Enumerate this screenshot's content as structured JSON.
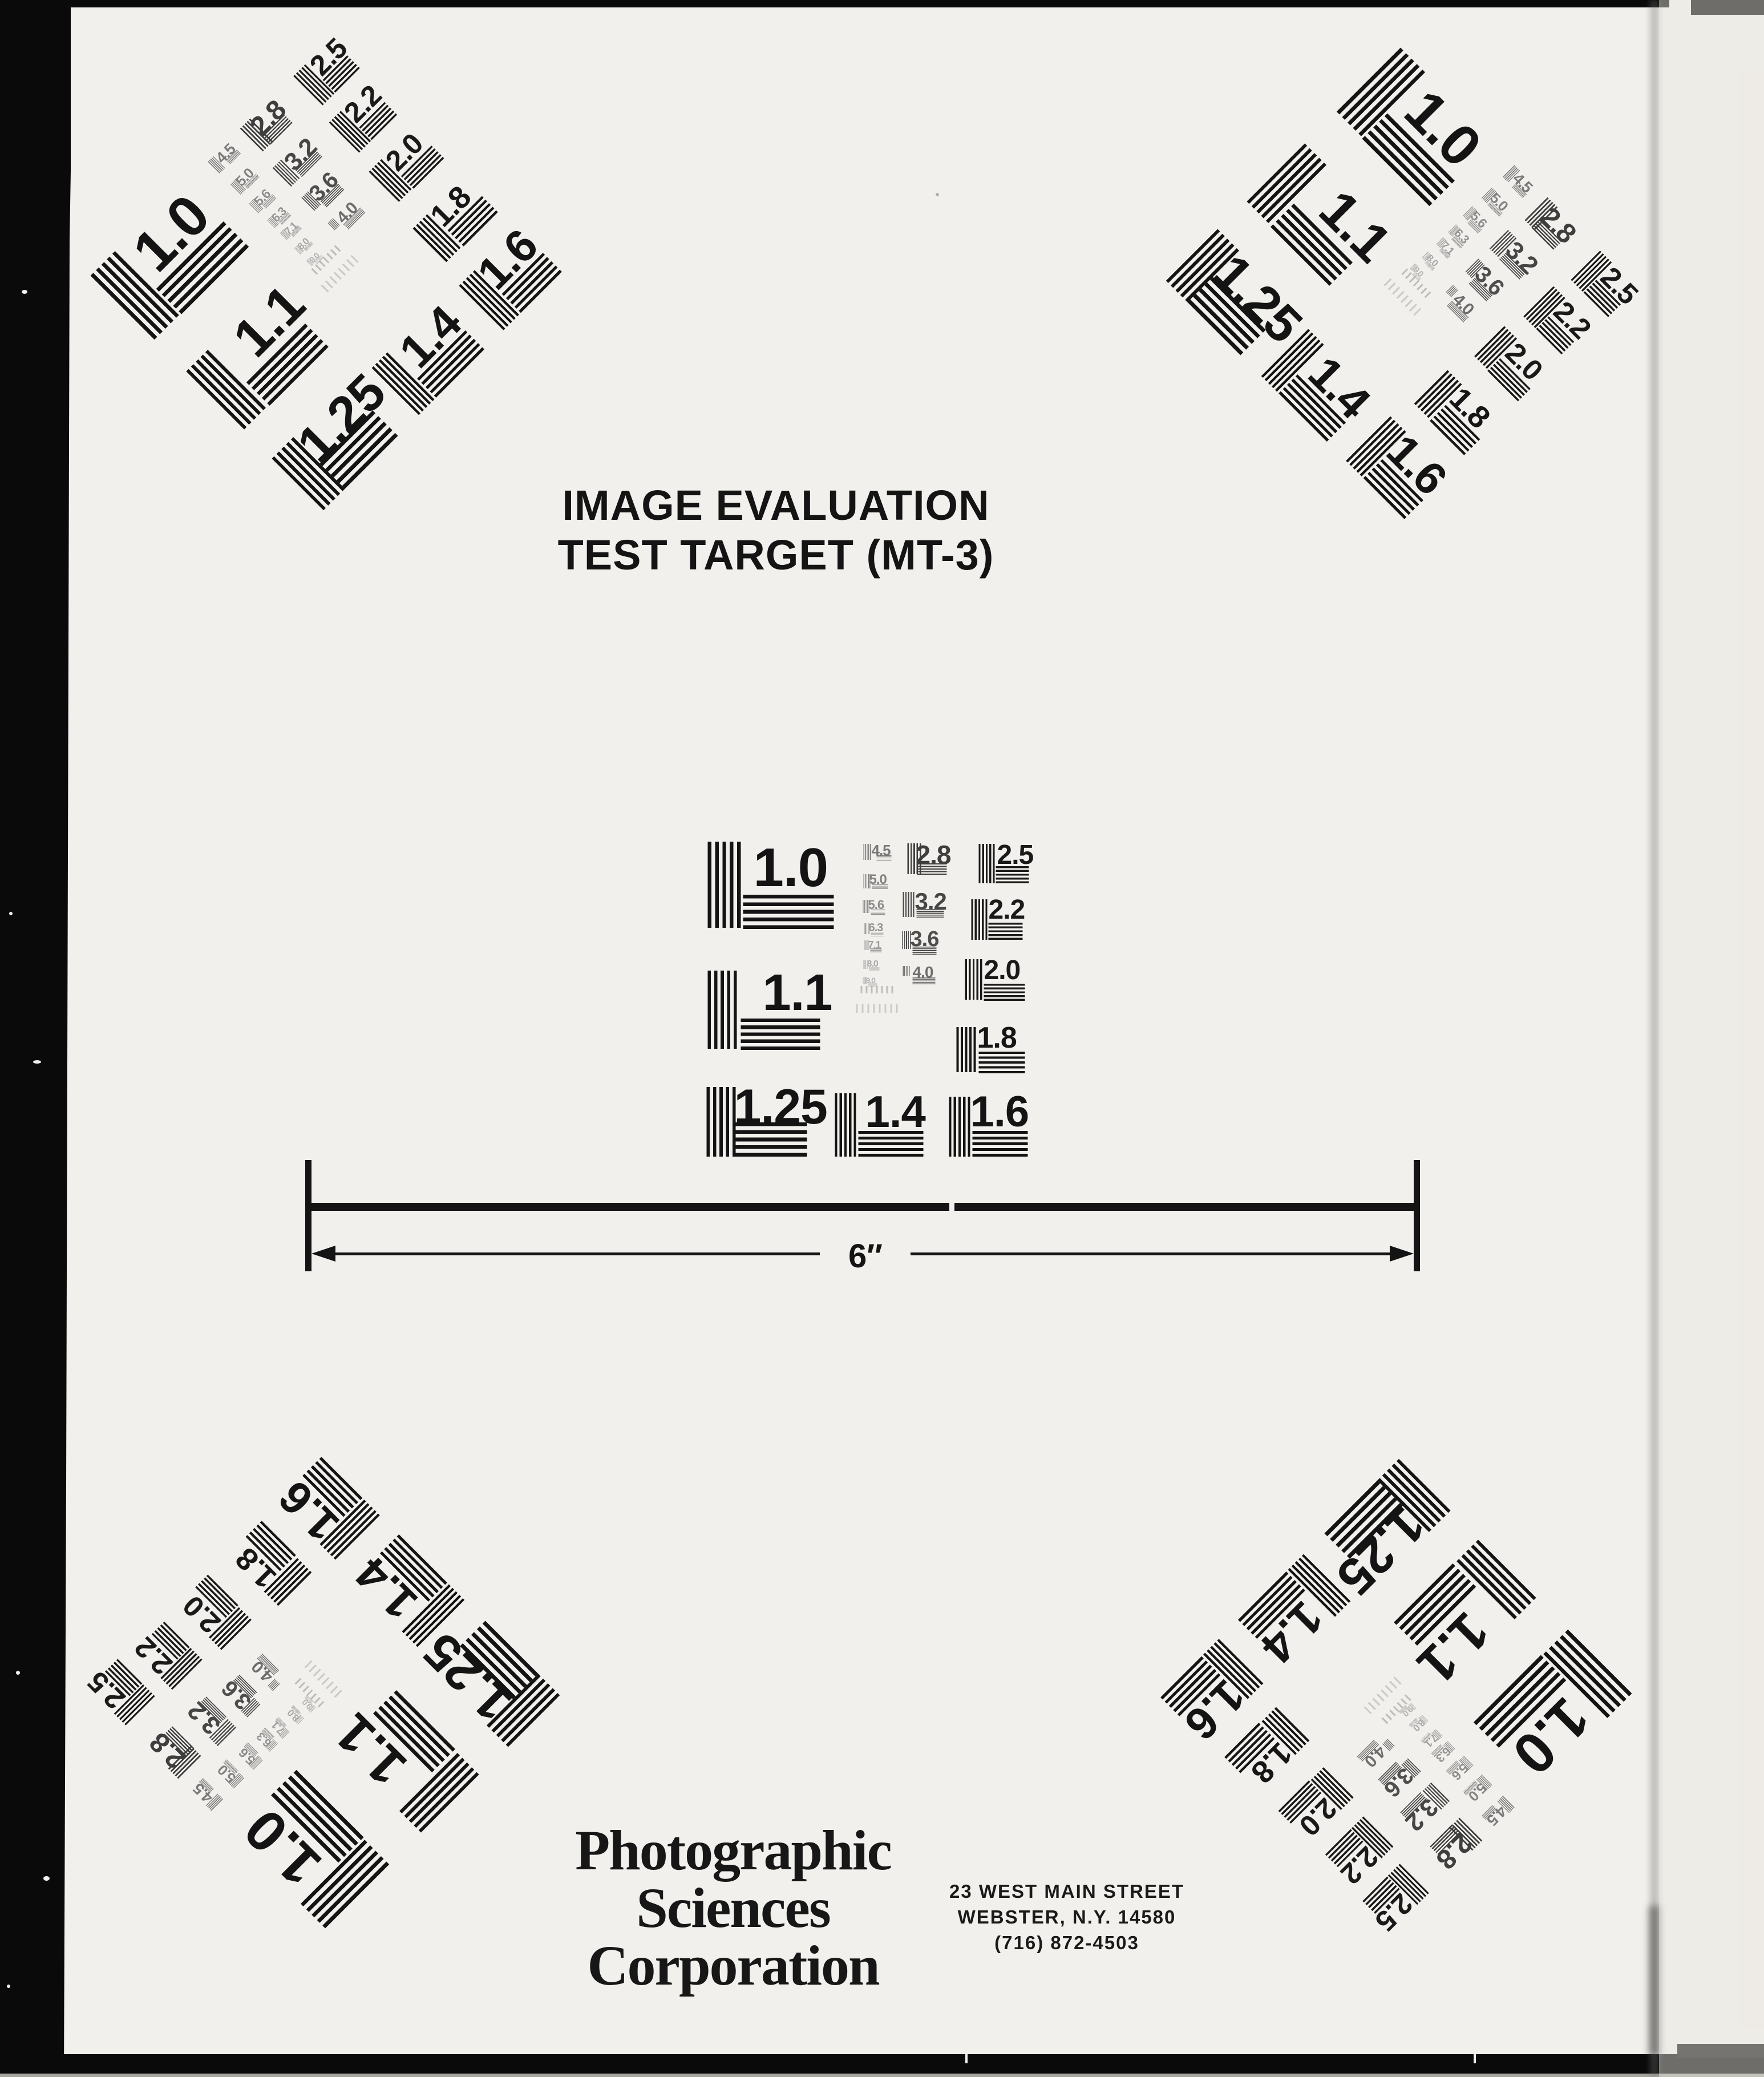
{
  "document": {
    "title_line1": "IMAGE EVALUATION",
    "title_line2": "TEST TARGET (MT-3)",
    "scale_label": "6″",
    "company_line1": "Photographic",
    "company_line2": "Sciences",
    "company_line3": "Corporation",
    "address_line1": "23 WEST MAIN STREET",
    "address_line2": "WEBSTER, N.Y. 14580",
    "address_line3": "(716) 872-4503"
  },
  "test_pattern": {
    "group_labels": [
      "1.0",
      "1.1",
      "1.25",
      "1.4",
      "1.6",
      "2.5",
      "2.2",
      "2.0",
      "1.8",
      "2.8",
      "3.2",
      "3.6",
      "4.0",
      "4.5",
      "5.0",
      "5.6",
      "6.3",
      "7.1",
      "8.0",
      "9.0"
    ],
    "instances": [
      "center",
      "top-left",
      "top-right",
      "bottom-left",
      "bottom-right"
    ]
  },
  "colors": {
    "ink": "#141414",
    "paper": "#f2f0ec",
    "faded_bar_gray": "#8c8c8c"
  }
}
